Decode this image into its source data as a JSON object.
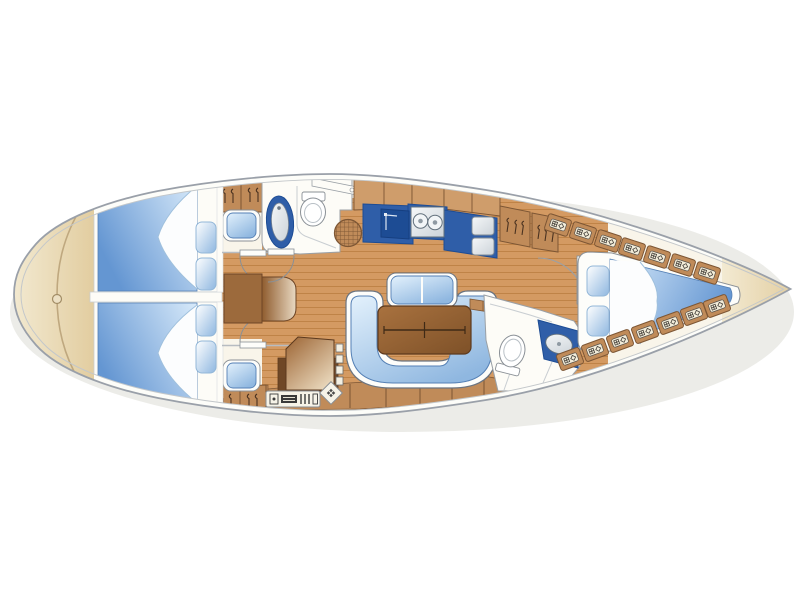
{
  "diagram_data": {
    "type": "diagram",
    "subject": "sailing-yacht-interior-floor-plan",
    "view": "top-down",
    "orientation": {
      "bow": "right",
      "stern": "left"
    },
    "areas": [
      {
        "name": "stern-deck",
        "features": [
          "transom-curve",
          "deck-fitting"
        ]
      },
      {
        "name": "aft-cabin-top",
        "features": [
          "double-berth",
          "sheet-fold",
          "pillow",
          "pillow",
          "seat-cushion",
          "door-with-swing",
          "wardrobe",
          "locker-hatch",
          "locker-hatch"
        ]
      },
      {
        "name": "aft-cabin-bottom",
        "features": [
          "double-berth",
          "sheet-fold",
          "pillow",
          "pillow",
          "seat-cushion",
          "door-with-swing",
          "wardrobe",
          "locker-hatch",
          "locker-hatch"
        ]
      },
      {
        "name": "head-top",
        "features": [
          "washbasin",
          "toilet",
          "shower-grate",
          "shelf",
          "door-with-swing"
        ]
      },
      {
        "name": "salon",
        "features": [
          "u-shaped-settee",
          "folding-table",
          "bench-seat",
          "center-seat",
          "side-shelf",
          "teak-floor"
        ]
      },
      {
        "name": "galley",
        "features": [
          "upper-cabinets",
          "counter",
          "stove",
          "double-sink",
          "refrigerator-boxes"
        ]
      },
      {
        "name": "nav-station",
        "features": [
          "chart-table",
          "switch-panel",
          "instrument-panel",
          "compass-tile"
        ]
      },
      {
        "name": "head-bottom",
        "features": [
          "toilet",
          "washbasin-counter",
          "shower-lines"
        ]
      },
      {
        "name": "forward-cabin",
        "features": [
          "v-berth",
          "sheet-fold",
          "pillow",
          "pillow",
          "door-with-swing",
          "wardrobe",
          "wardrobe",
          "locker-row-top",
          "locker-row-bottom"
        ]
      },
      {
        "name": "bow-deck",
        "features": []
      }
    ],
    "counts": {
      "aft_locker_hatches_top": 2,
      "aft_locker_hatches_bottom": 2,
      "forward_locker_hatches_top": 7,
      "forward_locker_hatches_bottom": 7,
      "pillows_total": 6,
      "cabins": 3,
      "heads": 2
    }
  },
  "colors": {
    "background": "#ffffff",
    "shadow": "#dcdcd6",
    "hull_fill": "#fdfdf9",
    "hull_outline": "#9aa0a9",
    "interior": "#f9f5ea",
    "wall_gray": "#c3c7ca",
    "line_gray": "#8a9096",
    "cream_light": "#f3ead2",
    "cream_dark": "#e2cda0",
    "cream_line": "#bfa87f",
    "teak": "#d49a62",
    "teak_seam": "#bf8347",
    "wood": "#c08b59",
    "wood_light": "#cf9d6b",
    "wood_dark": "#7d5634",
    "table_light": "#a9723f",
    "table_dark": "#7e5128",
    "counter_blue": "#2f5ea8",
    "counter_blue_dark": "#1d4c94",
    "berth_light": "#d8eafa",
    "berth_deep": "#6496d2",
    "cushion_light": "#e3f1fc",
    "cushion_blue": "#8fb7e0",
    "cushion_edge": "#5580b5",
    "metal_light": "#f5f7f8",
    "metal": "#ccd3d9",
    "white": "#fdfdfa"
  }
}
